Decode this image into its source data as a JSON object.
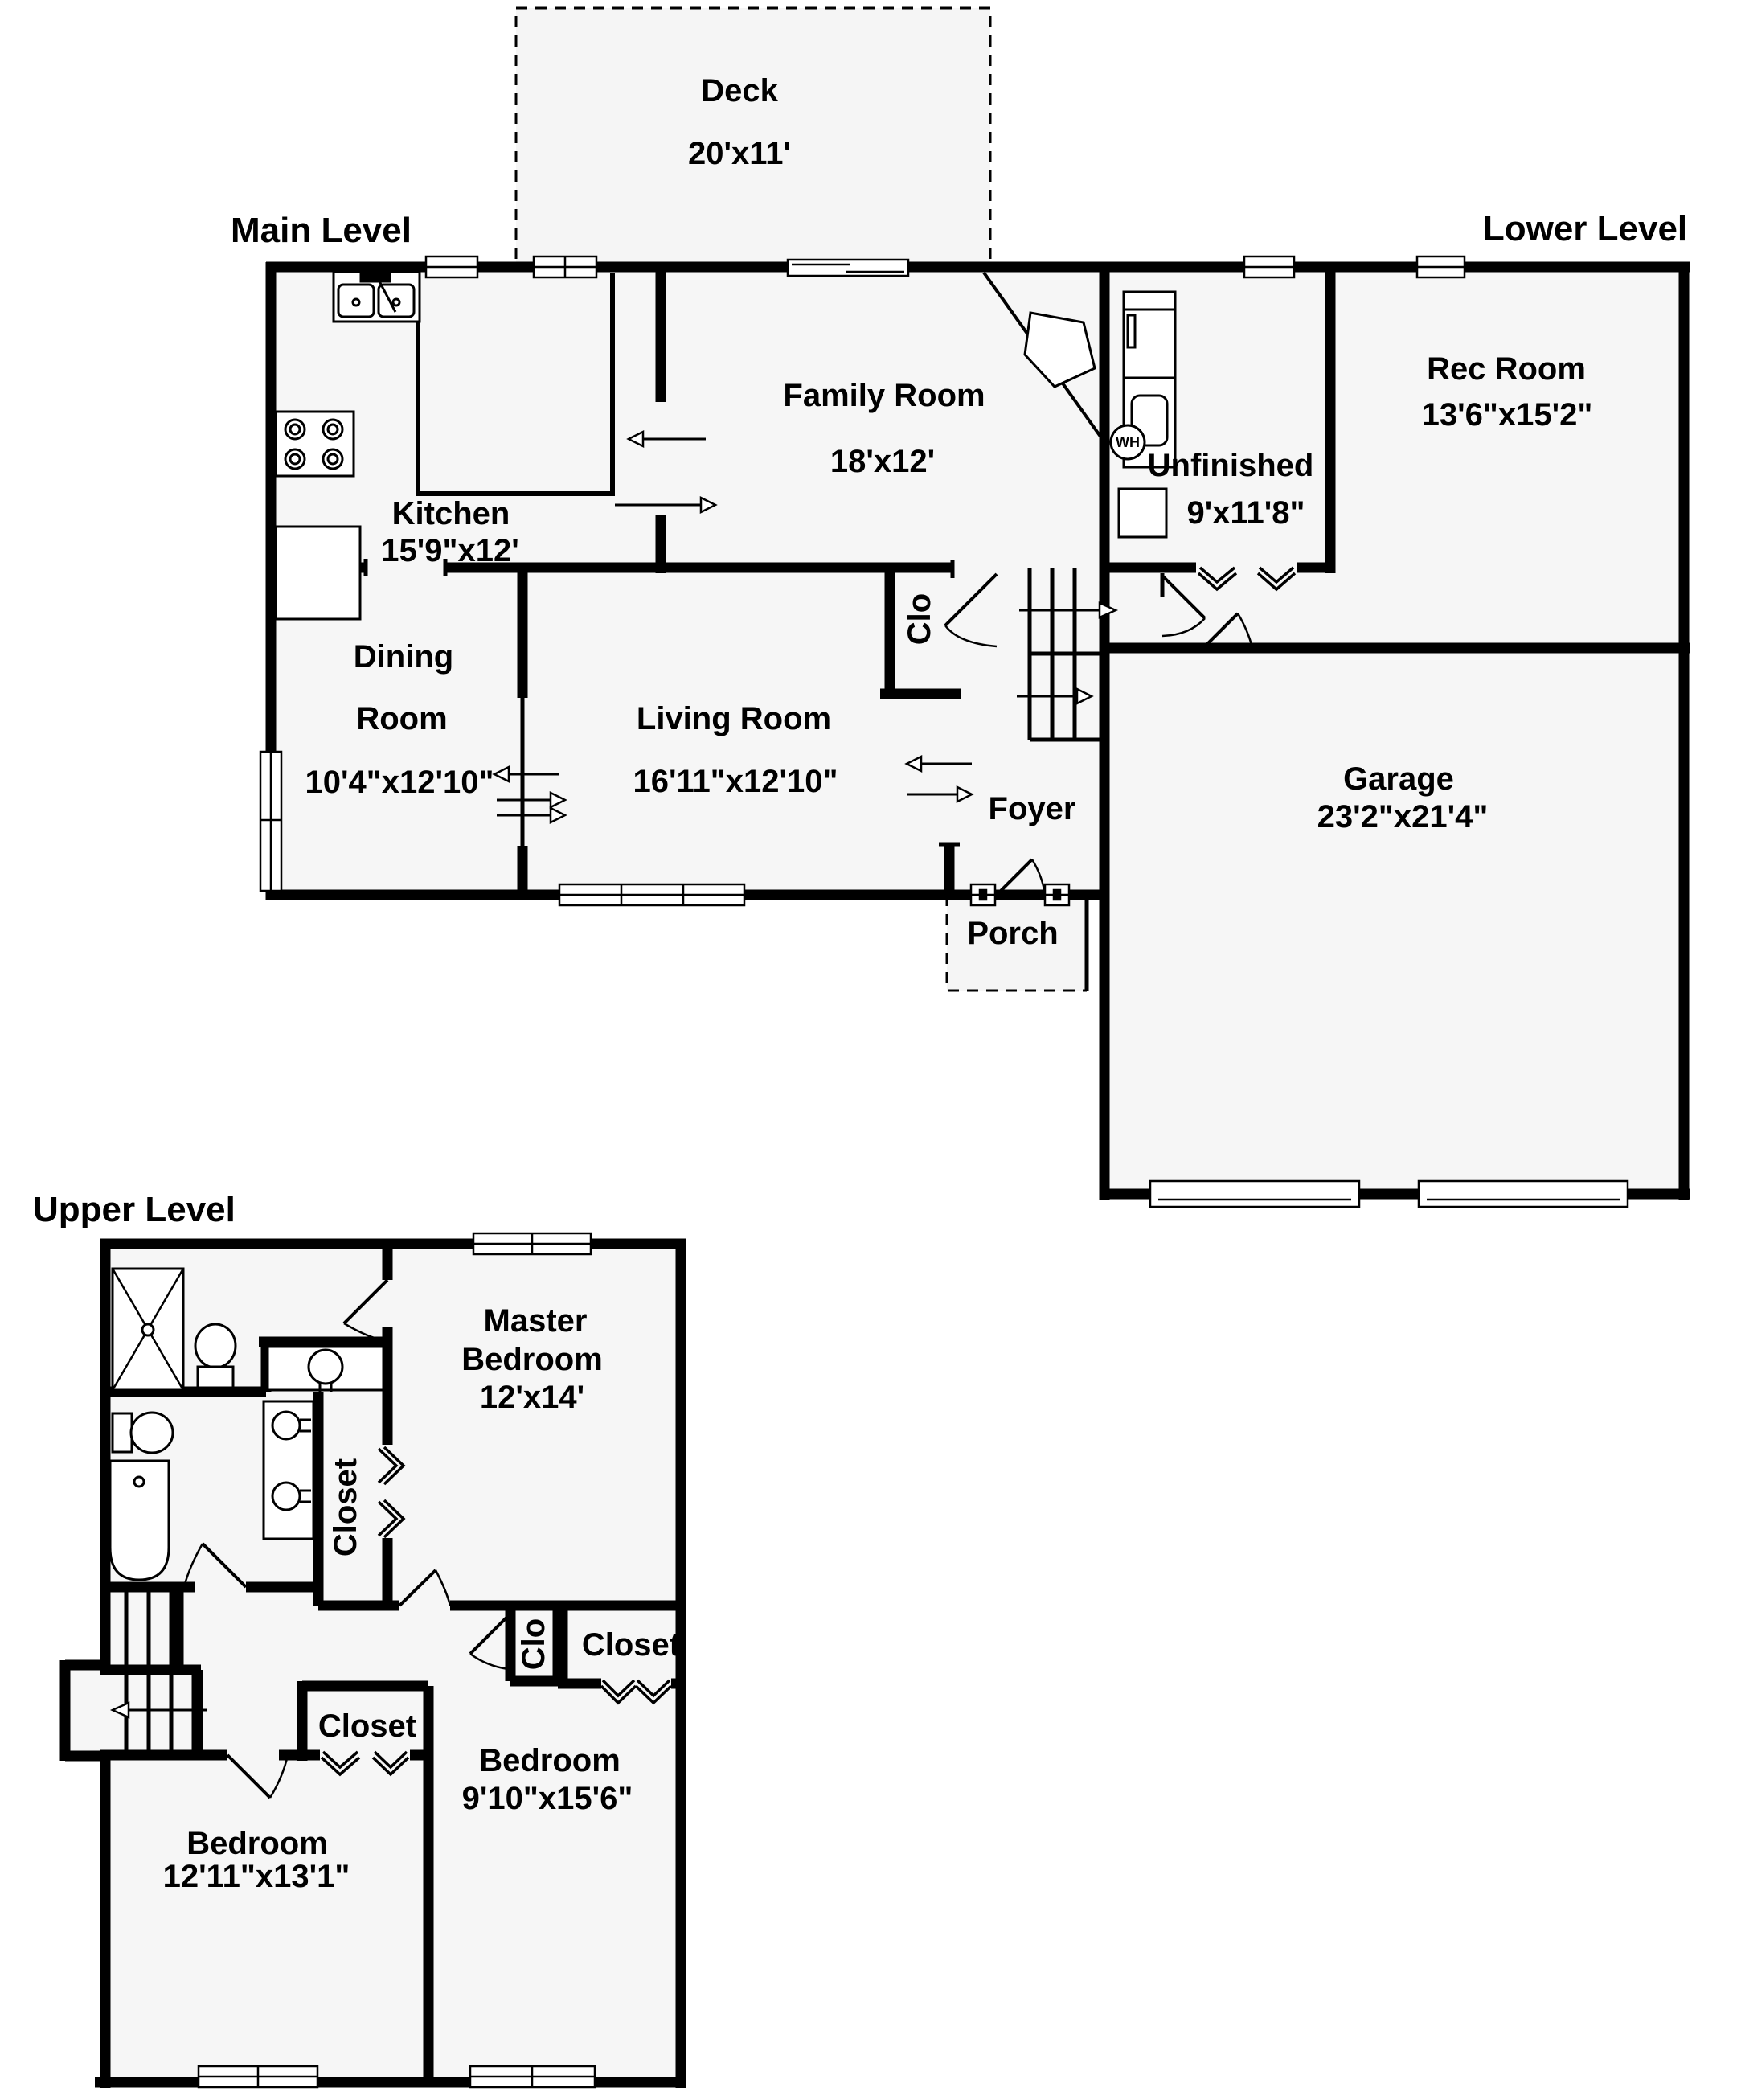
{
  "levels": {
    "main": "Main Level",
    "lower": "Lower Level",
    "upper": "Upper Level"
  },
  "rooms": {
    "deck": {
      "name": "Deck",
      "dims": "20'x11'"
    },
    "family": {
      "name": "Family Room",
      "dims": "18'x12'"
    },
    "kitchen": {
      "name": "Kitchen",
      "dims": "15'9\"x12'"
    },
    "dining": {
      "line1": "Dining",
      "line2": "Room",
      "dims": "10'4\"x12'10\""
    },
    "living": {
      "name": "Living Room",
      "dims": "16'11\"x12'10\""
    },
    "foyer": {
      "name": "Foyer"
    },
    "porch": {
      "name": "Porch"
    },
    "closet_main": {
      "name": "Clo"
    },
    "rec": {
      "name": "Rec Room",
      "dims": "13'6\"x15'2\""
    },
    "unfinished": {
      "name": "Unfinished",
      "dims": "9'x11'8\""
    },
    "water_heater": {
      "name": "WH"
    },
    "garage": {
      "name": "Garage",
      "dims": "23'2\"x21'4\""
    },
    "master": {
      "line1": "Master",
      "line2": "Bedroom",
      "dims": "12'x14'"
    },
    "master_closet": {
      "name": "Closet"
    },
    "closet_upper": {
      "name": "Clo"
    },
    "closet_bedroom2": {
      "name": "Closet"
    },
    "closet_bedroom3": {
      "name": "Closet"
    },
    "bedroom2": {
      "name": "Bedroom",
      "dims": "9'10\"x15'6\""
    },
    "bedroom3": {
      "name": "Bedroom",
      "dims": "12'11\"x13'1\""
    }
  }
}
